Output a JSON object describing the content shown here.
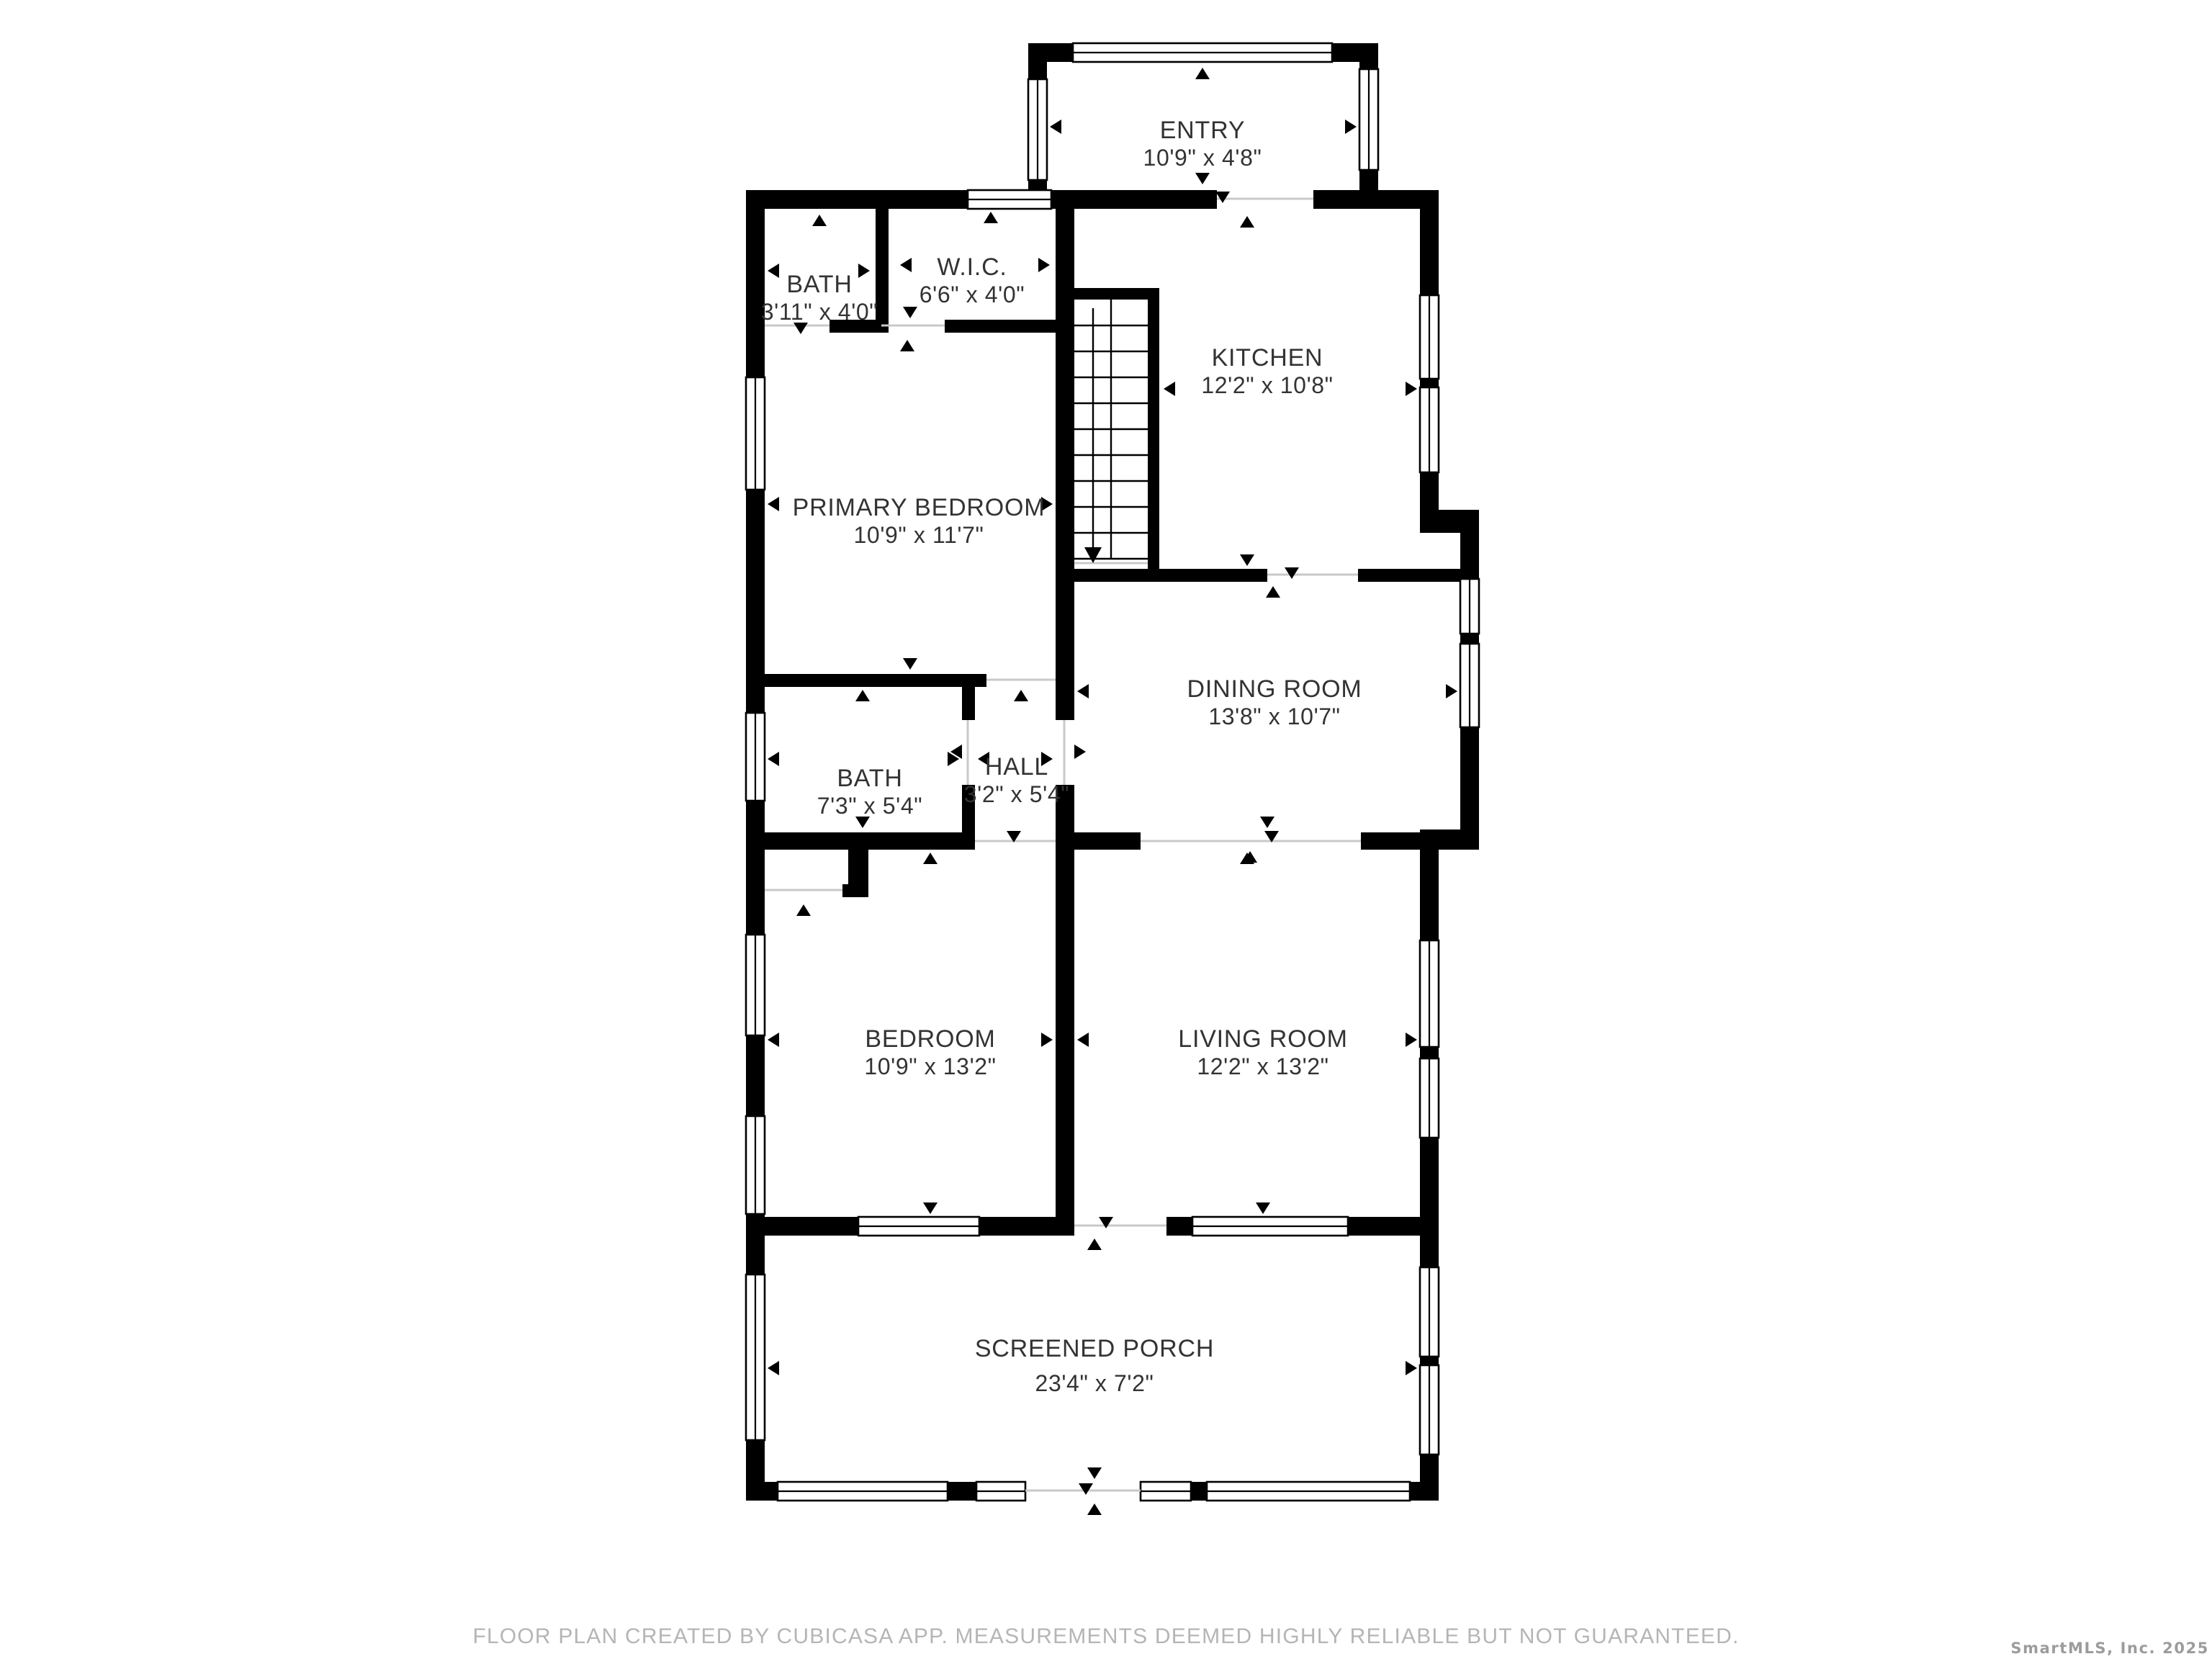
{
  "page": {
    "background": "#ffffff",
    "kind": "floor-plan"
  },
  "colors": {
    "wall": "#000000",
    "room_label": "#333333",
    "open_line": "#c9c9c9",
    "footer_text": "#b5b5b5",
    "watermark_text": "#9c9c9c"
  },
  "rooms": [
    {
      "id": "entry",
      "name": "ENTRY",
      "dims": "10'9\" x 4'8\""
    },
    {
      "id": "bath-upper",
      "name": "BATH",
      "dims": "3'11\" x 4'0\""
    },
    {
      "id": "wic",
      "name": "W.I.C.",
      "dims": "6'6\" x 4'0\""
    },
    {
      "id": "kitchen",
      "name": "KITCHEN",
      "dims": "12'2\" x 10'8\""
    },
    {
      "id": "primary-bedroom",
      "name": "PRIMARY BEDROOM",
      "dims": "10'9\" x 11'7\""
    },
    {
      "id": "dining-room",
      "name": "DINING ROOM",
      "dims": "13'8\" x 10'7\""
    },
    {
      "id": "bath-middle",
      "name": "BATH",
      "dims": "7'3\" x 5'4\""
    },
    {
      "id": "hall",
      "name": "HALL",
      "dims": "3'2\" x 5'4\""
    },
    {
      "id": "bedroom",
      "name": "BEDROOM",
      "dims": "10'9\" x 13'2\""
    },
    {
      "id": "living-room",
      "name": "LIVING ROOM",
      "dims": "12'2\" x 13'2\""
    },
    {
      "id": "screened-porch",
      "name": "SCREENED PORCH",
      "dims": "23'4\" x 7'2\""
    }
  ],
  "stairs": {
    "direction": "down",
    "treads": 10
  },
  "footer": {
    "text": "FLOOR PLAN CREATED BY CUBICASA APP. MEASUREMENTS DEEMED HIGHLY RELIABLE BUT NOT GUARANTEED."
  },
  "watermark": {
    "text": "SmartMLS, Inc. 2025"
  }
}
